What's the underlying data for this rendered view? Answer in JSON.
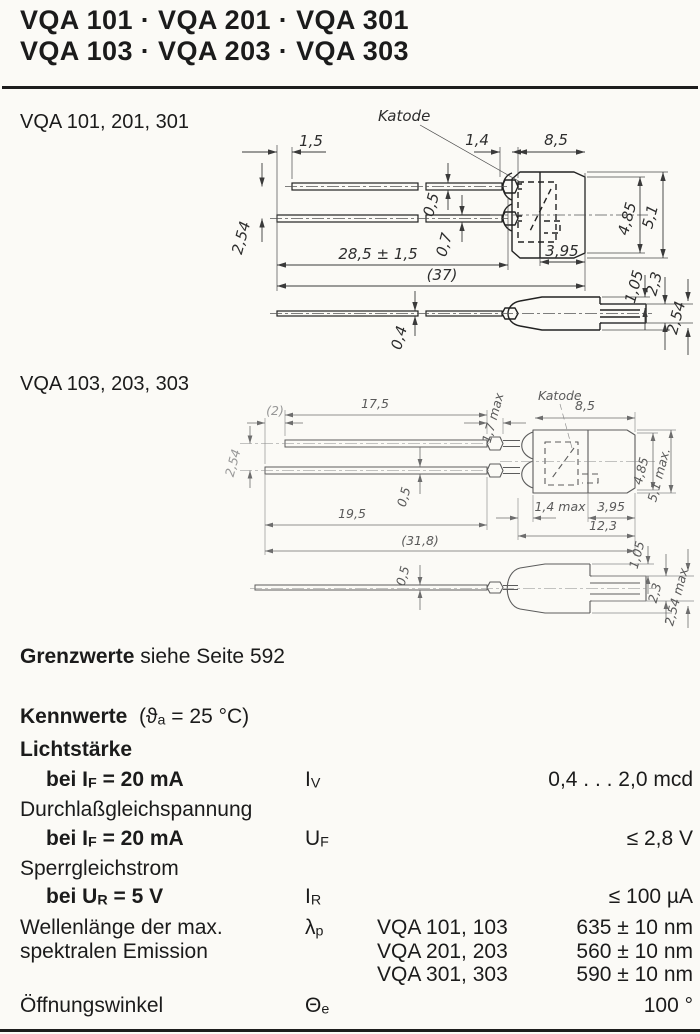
{
  "header": {
    "line1": "VQA 101 · VQA 201 · VQA 301",
    "line2": "VQA 103 · VQA 203 · VQA 303"
  },
  "section1": {
    "label": "VQA 101, 201, 301"
  },
  "section2": {
    "label": "VQA 103, 203, 303"
  },
  "grenzwerte": {
    "bold": "Grenzwerte",
    "rest": " siehe Seite 592"
  },
  "kennwerte": {
    "heading": "Kennwerte",
    "cond_pre": "(ϑ",
    "cond_sub": "a",
    "cond_post": " = 25 °C)"
  },
  "rows": {
    "lichtstaerke": "Lichtstärke",
    "r1": {
      "pre": "bei I",
      "sub": "F",
      "post": " = 20 mA",
      "sym": "I",
      "sym_sub": "V",
      "val": "0,4 . . . 2,0 mcd"
    },
    "durchlass": "Durchlaßgleichspannung",
    "r2": {
      "pre": "bei I",
      "sub": "F",
      "post": " = 20 mA",
      "sym": "U",
      "sym_sub": "F",
      "val": "≤ 2,8 V"
    },
    "sperr": "Sperrgleichstrom",
    "r3": {
      "pre": "bei U",
      "sub": "R",
      "post": " = 5 V",
      "sym": "I",
      "sym_sub": "R",
      "val": "≤ 100 µA"
    },
    "wellen1": "Wellenlänge der max.",
    "wellen2": "spektralen Emission",
    "lambda_sym": "λ",
    "lambda_sub": "p",
    "w1": {
      "device": "VQA 101, 103",
      "val": "635 ± 10 nm"
    },
    "w2": {
      "device": "VQA 201, 203",
      "val": "560 ± 10 nm"
    },
    "w3": {
      "device": "VQA 301, 303",
      "val": "590 ± 10 nm"
    },
    "oeffnung": {
      "label": "Öffnungswinkel",
      "sym": "Θ",
      "sym_sub": "e",
      "val": "100 °"
    }
  },
  "drawing1": {
    "katode": "Katode",
    "dims": {
      "offset": "1,5",
      "crimp": "1,4",
      "body_len": "8,5",
      "lead1_t": "0,5",
      "lead2_t": "0,7",
      "pitch": "2,54",
      "lead_len": "28,5 ± 1,5",
      "total": "(37)",
      "cap_len": "3,95",
      "face_d": "4,85",
      "body_d": "5,1",
      "nose_a": "1,05",
      "nose_b": "2,3",
      "bottom_lead_t": "0,4",
      "tab_w": "2,54"
    }
  },
  "drawing2": {
    "katode": "Katode",
    "dims": {
      "offset": "(2)",
      "lead1_len": "17,5",
      "crimp_t": "1,7 max",
      "body_len": "8,5",
      "pitch": "2,54",
      "lead_t": "0,5",
      "lead2_len": "19,5",
      "crimp_len": "1,4 max",
      "cap_len": "3,95",
      "seat_len": "12,3",
      "total": "(31,8)",
      "face_d": "4,85",
      "body_d": "5,1 max.",
      "bottom_lead_t": "0,5",
      "nose_a": "1,05",
      "nose_b": "2,3",
      "tab_w": "2,54 max."
    }
  }
}
